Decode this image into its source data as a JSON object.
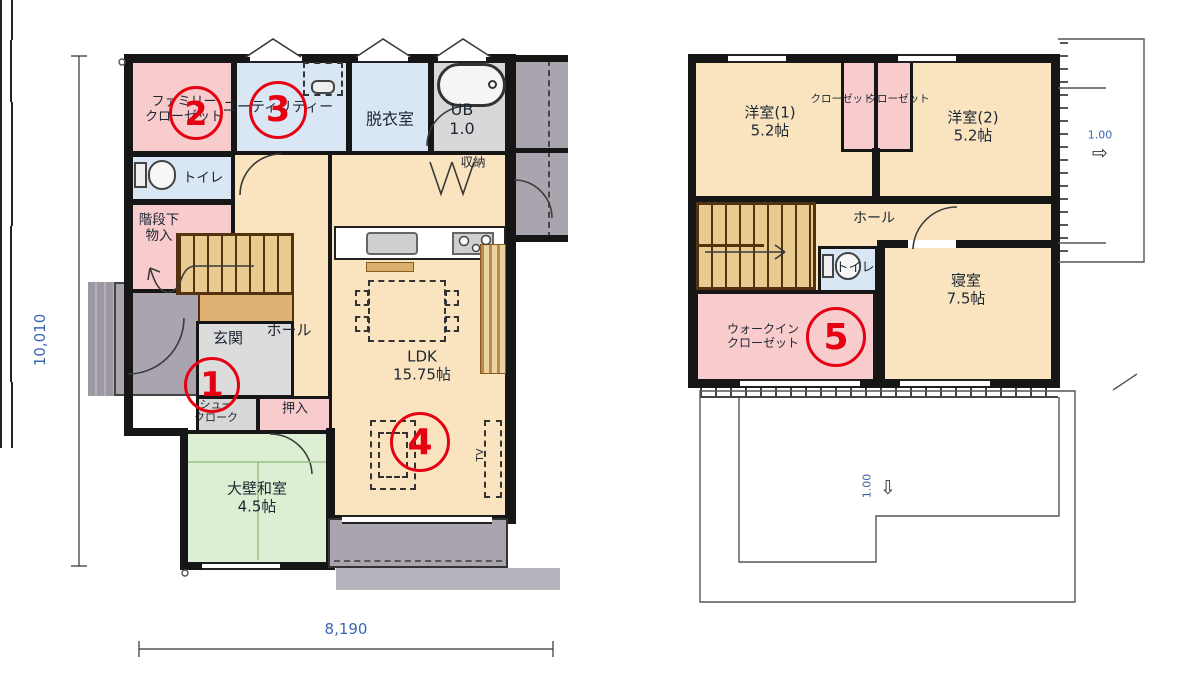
{
  "floor1": {
    "rooms": {
      "family_closet": "ファミリー\nクローゼット",
      "utility": "ユーティリティー",
      "dressing_room": "脱衣室",
      "unit_bath": "UB\n1.0",
      "toilet": "トイレ",
      "under_stairs_storage": "階段下\n物入",
      "storage": "収納",
      "entrance": "玄関",
      "hall": "ホール",
      "shoe_cloak": "シュー\nクローク",
      "oshiire": "押入",
      "japanese_room": "大壁和室\n4.5帖",
      "ldk": "LDK\n15.75帖",
      "tv": "TV"
    },
    "markers": {
      "entrance": "1",
      "family_closet": "2",
      "utility": "3",
      "ldk": "4"
    }
  },
  "floor2": {
    "rooms": {
      "western_room1": "洋室(1)\n5.2帖",
      "closet1": "クローゼット",
      "closet2": "クローゼット",
      "western_room2": "洋室(2)\n5.2帖",
      "hall": "ホール",
      "toilet": "トイレ",
      "walk_in_closet": "ウォークイン\nクローゼット",
      "bedroom": "寝室\n7.5帖"
    },
    "markers": {
      "walk_in_closet": "5"
    },
    "roof_slope_right": "1.00",
    "roof_slope_bottom": "1.00"
  },
  "dimensions": {
    "height": "10,010",
    "width": "8,190"
  },
  "icons": {
    "arrow_right": "⇨",
    "arrow_down": "⇩"
  },
  "colors": {
    "wall": "#161616",
    "marker_red": "#e60012",
    "dimension_blue": "#3b66b3",
    "room_cream": "#fae4c0",
    "closet_pink": "#f8cccc",
    "wet_blue": "#d9e6f4",
    "tatami_green": "#ddefd2",
    "terrace_gray": "#a9a4ad",
    "stairs_tan": "#e9cb92"
  }
}
